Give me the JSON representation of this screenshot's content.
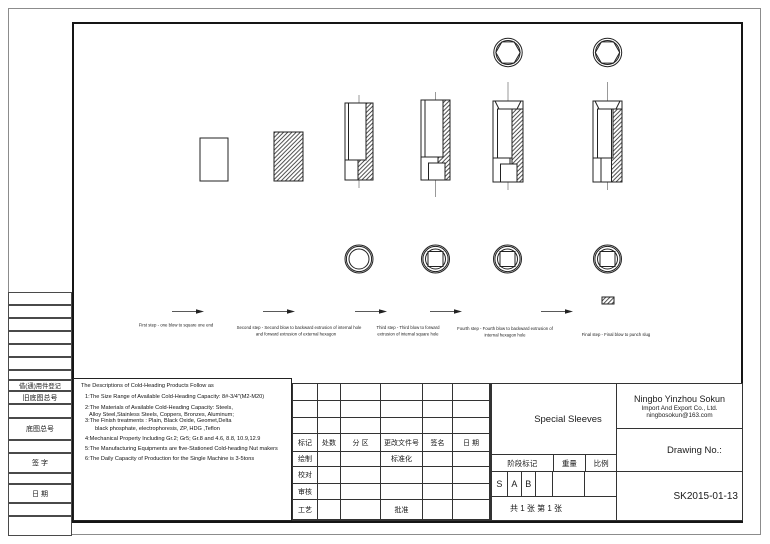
{
  "left_strip": {
    "reuse_label": "借(通)用件登记",
    "old_base_no_label": "旧底图总号",
    "base_no_label": "底图总号",
    "signature_label": "签 字",
    "date_label": "日 期"
  },
  "drawing": {
    "captions": {
      "step1": "First step - one blow to square one end",
      "step2_l1": "Second step - Second blow to backward extrusion of internal hole",
      "step2_l2": "and forward extrusion of external hexagon",
      "step3_l1": "Third step - Third blow to forward",
      "step3_l2": "extrusion of internal square hole",
      "step4_l1": "Fourth step - Fourth blow to backward extrusion of",
      "step4_l2": "internal hexagon hole",
      "step5": "Final step - Final blow to punch slug"
    }
  },
  "descriptions": {
    "lines": [
      "The Descriptions of Cold-Heading Products Follow as",
      "1:The Size Range of Available Cold-Heading Capacity: 8#-3/4\"(M2-M20)",
      "2:The Materials of Available Cold-Heading Capacity: Steels,",
      "Alloy Steel,Stainless Steels, Coppers, Bronzes, Aluminum;",
      "3:The Finish treatments : Plain, Black Oxide, Geomet,Delta",
      "black phosphate, electrophoresis, ZP, HDG ,Teflon",
      "4:Mechanical Property Including Gr.2; Gr5; Gr.8 and 4.6, 8.8, 10.9,12.9",
      "5:The Manufacturing Equipments are five-Stationed Cold-heading Nut makers",
      "6:The Daily Capacity of Production for the Single Machine is 3-5tons"
    ]
  },
  "change_table": {
    "headers": [
      "标记",
      "处数",
      "分 区",
      "更改文件号",
      "签名",
      "日 期"
    ],
    "row_labels": [
      "绘制",
      "校对",
      "审核",
      "工艺"
    ],
    "standardization_label": "标准化",
    "approval_label": "批准"
  },
  "title_block": {
    "part_name": "Special Sleeves",
    "company_name": "Ningbo Yinzhou Sokun",
    "company_sub": "Import And Export Co., Ltd.",
    "company_email": "ningbosokun@163.com",
    "stage_label": "阶段标记",
    "weight_label": "重量",
    "scale_label": "比例",
    "stage_marks": [
      "S",
      "A",
      "B"
    ],
    "sheet_info": "共 1 张  第 1 张",
    "drawing_no_label": "Drawing No.:",
    "drawing_no": "SK2015-01-13"
  },
  "colors": {
    "line": "#222222",
    "frame": "#151515",
    "outer_border": "#8c8c8c",
    "background": "#ffffff"
  }
}
